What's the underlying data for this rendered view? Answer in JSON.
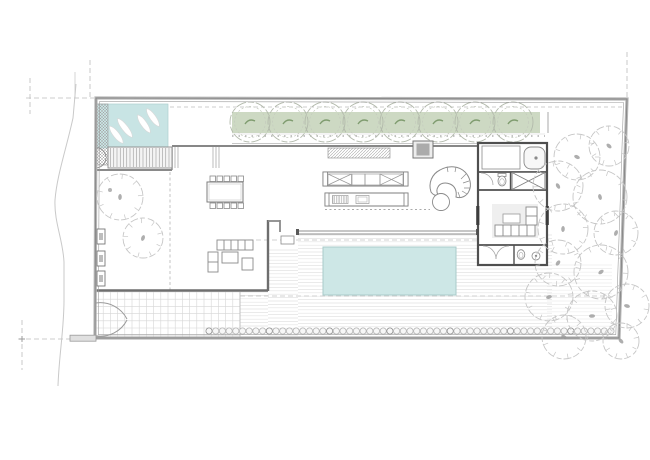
{
  "meta": {
    "type": "architectural-floor-plan",
    "description": "single-storey residence site plan with central swimming pool, entry water feature, tree planter band and side garden"
  },
  "colors": {
    "paper": "#ffffff",
    "boundary_wall": "#b6b6b6",
    "boundary_edge": "#858585",
    "wall": "#8a8a8a",
    "wall_dark": "#4f4f4f",
    "door_dark": "#3d3d3d",
    "dashed": "#bdbdbd",
    "deck_plank": "#e3e3e3",
    "deck_plank_light": "#ececec",
    "grid": "#d6d6d6",
    "pool_water": "#cde7e6",
    "pool_edge": "#a9cbca",
    "water_feature": "#c8e4e4",
    "water_edge": "#aed0d0",
    "planter_green": "#cdd9c3",
    "band_tree_stroke": "#b2b9ab",
    "band_tree_inner": "#c4cabd",
    "tree_mark_green": "#7f9c6f",
    "sketch_tree": "#c6c6c6",
    "tree_dot": "#9a9a9a",
    "rug": "#efefef",
    "furniture": "#8a8a8a"
  },
  "site": {
    "boundary_points": "96,98 627,99 619,338 95,338",
    "boundary_inner_points": "99.5,101.5 623.5,102.5 615.8,334.6 98.3,334.6"
  },
  "deck": {
    "dash_top_y": 240,
    "dash_bottom_y": 296,
    "rects": [
      {
        "x": 298,
        "y": 235,
        "w": 254,
        "h": 101,
        "step": 3.4,
        "c": "#e3e3e3"
      },
      {
        "x": 268,
        "y": 250,
        "w": 30,
        "h": 86,
        "step": 3.4,
        "c": "#e3e3e3"
      },
      {
        "x": 240,
        "y": 292,
        "w": 28,
        "h": 44,
        "step": 3.4,
        "c": "#e3e3e3"
      },
      {
        "x": 547,
        "y": 265,
        "w": 65,
        "h": 71,
        "step": 3.6,
        "c": "#ececec"
      }
    ]
  },
  "pool": {
    "x": 323,
    "y": 247,
    "w": 133,
    "h": 48
  },
  "water_feature": {
    "x": 97,
    "y": 104,
    "w": 71,
    "h": 44
  },
  "planter": {
    "band": {
      "x": 232,
      "y": 112,
      "w": 308,
      "h": 21
    },
    "tree_y": 122,
    "tree_r": 20,
    "tree_inner_r": 15.5,
    "tree_xs": [
      250,
      288,
      325,
      363,
      400,
      438,
      475,
      513
    ]
  },
  "patio": {
    "x": 96,
    "y": 292,
    "w": 144,
    "h": 45,
    "cell": 7.2
  },
  "entry_stairs": {
    "x0": 110.5,
    "x1": 169.5,
    "y0": 148,
    "y1": 167,
    "step": 3.25
  },
  "hedge": {
    "x0": 209,
    "step": 6.7,
    "count": 61,
    "y": 331,
    "r": 3.1
  },
  "grill": {
    "x": 333,
    "y": 196,
    "w": 14.5,
    "h": 7,
    "step": 1.7
  },
  "dining": {
    "table": {
      "x": 207,
      "y": 182,
      "w": 36,
      "h": 20
    },
    "chairs": {
      "xs": [
        210,
        217,
        224,
        231,
        238
      ],
      "top_y": 176,
      "bottom_y": 203,
      "size": 5.5
    }
  },
  "trees": {
    "garden": [
      [
        577,
        157,
        23
      ],
      [
        609,
        146,
        20
      ],
      [
        558,
        186,
        25
      ],
      [
        600,
        197,
        27
      ],
      [
        563,
        229,
        25
      ],
      [
        616,
        233,
        22
      ],
      [
        558,
        263,
        23
      ],
      [
        601,
        272,
        27
      ],
      [
        549,
        297,
        24
      ],
      [
        592,
        316,
        25
      ],
      [
        627,
        306,
        22
      ],
      [
        564,
        337,
        22
      ],
      [
        621,
        341,
        18
      ]
    ],
    "courtyard": [
      [
        120,
        197,
        23
      ],
      [
        143,
        238,
        20
      ]
    ]
  },
  "elements": [
    "boundary-wall",
    "entry-water-feature",
    "entry-stairs",
    "entry-gate",
    "planter-tree-row",
    "dining-table",
    "courtyard-trees",
    "living-sofa",
    "kitchen-islands",
    "curved-lounge",
    "fireplace",
    "bedroom-wing",
    "wardrobe",
    "bathrooms",
    "pool-deck",
    "swimming-pool",
    "hedge-row",
    "driveway-patio",
    "driveway-gate",
    "garden-trees",
    "road-contour"
  ]
}
